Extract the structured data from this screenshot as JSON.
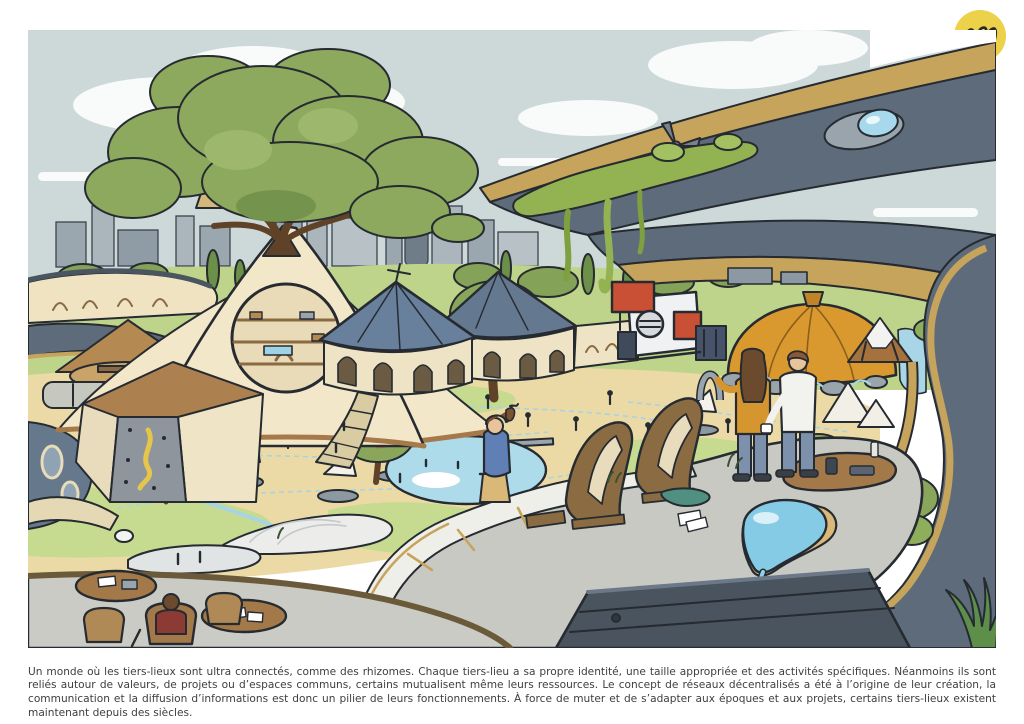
{
  "branding": {
    "cc_badge": {
      "symbol": "cc",
      "line1": "creative",
      "line2": "commons"
    },
    "squiggle_logo_color": "#ecd14b"
  },
  "caption": {
    "text": "Un monde où les tiers-lieux sont ultra connectés, comme des rhizomes. Chaque tiers-lieu a sa propre identité, une taille appropriée et des activités spécifiques. Néanmoins ils sont reliés autour de valeurs, de projets ou d’espaces communs, certains mutualisent même leurs ressources. Le concept de réseaux décentralisés a été à l’origine de leur création, la communication et la diffusion d’informations est donc un pilier de leurs fonctionnements. À force de muter et de s’adapter aux époques et aux projets, certains tiers-lieux existent maintenant depuis des siècles."
  },
  "illustration": {
    "description": "Illustrated utopian tiers-lieux landscape: a giant tree growing on a cream tent with a round window, blue conical pavilions, a red and white modular building, an orange dome, teepees and canvas tents, a city skyline behind, a huge curved gold-and-grey megastructure framing the right side with hanging moss, a small wind turbine, ponds, rhizome-like blue paths, terraces with tables and six people.",
    "palette": {
      "sky": "#cdd9d8",
      "cloud": "#f8fbf9",
      "outline": "#262b31",
      "foliage": "#8ca95d",
      "lawn": "#c6db90",
      "sand": "#ecdaa6",
      "tent_cream": "#f2e7c9",
      "tent_brown": "#b58a52",
      "roof_blue": "#68809b",
      "structure_dark": "#5d6b7b",
      "structure_gold": "#c7a45c",
      "water": "#aedbe9",
      "accent_red": "#c94f35",
      "accent_orange": "#d9992f",
      "platform_grey": "#c9c9c3",
      "logo_yellow": "#ecd14b"
    }
  }
}
